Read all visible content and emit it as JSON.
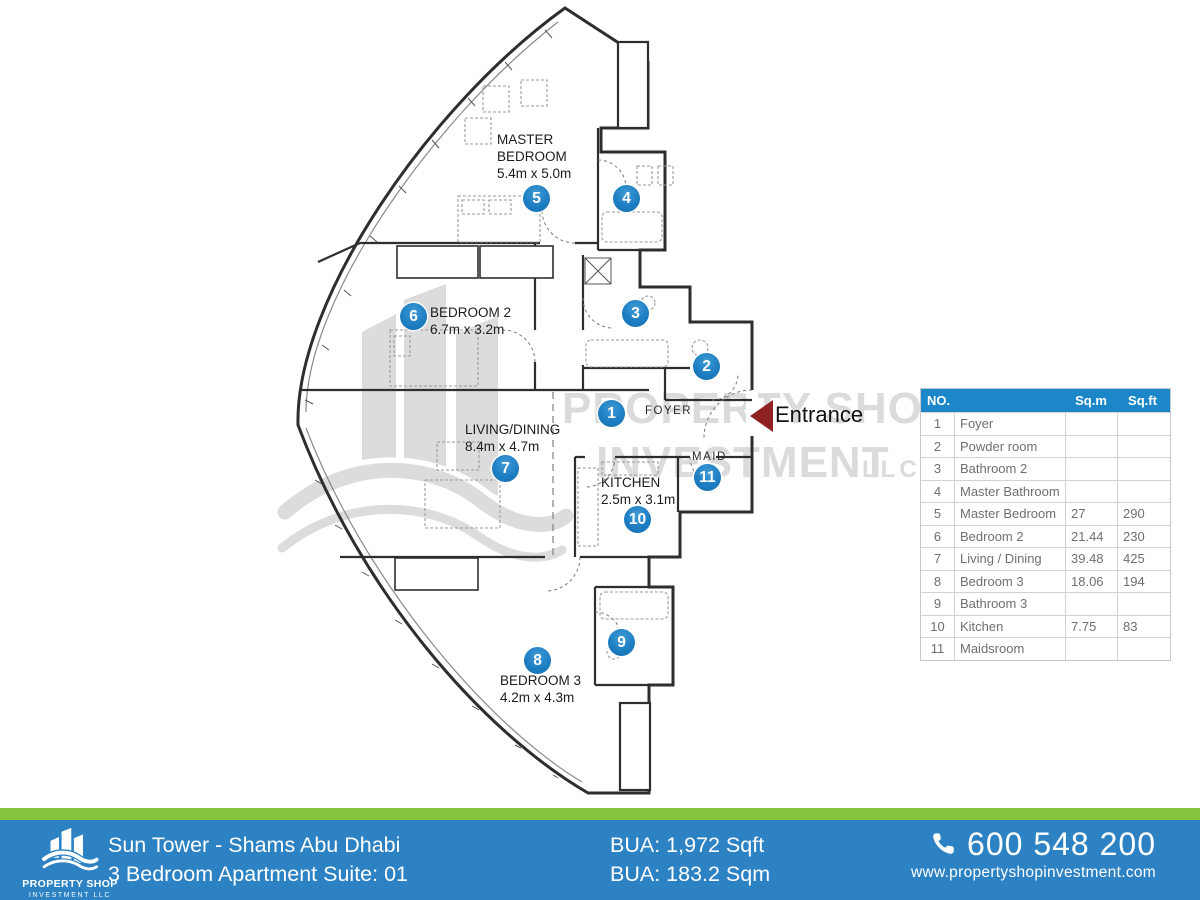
{
  "plan": {
    "entrance_label": "Entrance",
    "labels": [
      {
        "id": "master-bedroom",
        "lines": [
          "MASTER",
          "BEDROOM"
        ],
        "dims": "5.4m x 5.0m"
      },
      {
        "id": "bedroom-2",
        "lines": [
          "BEDROOM 2"
        ],
        "dims": "6.7m x 3.2m"
      },
      {
        "id": "living-dining",
        "lines": [
          "LIVING/DINING"
        ],
        "dims": "8.4m x 4.7m"
      },
      {
        "id": "kitchen",
        "lines": [
          "KITCHEN"
        ],
        "dims": "2.5m x 3.1m"
      },
      {
        "id": "bedroom-3",
        "lines": [
          "BEDROOM 3"
        ],
        "dims": "4.2m x 4.3m"
      },
      {
        "id": "foyer",
        "lines": [
          "FOYER"
        ],
        "dims": ""
      },
      {
        "id": "maid",
        "lines": [
          "MAID"
        ],
        "dims": ""
      }
    ],
    "markers": [
      "1",
      "2",
      "3",
      "4",
      "5",
      "6",
      "7",
      "8",
      "9",
      "10",
      "11"
    ]
  },
  "watermark": {
    "line1": "PROPERTY SHOP",
    "line2": "INVESTMENT",
    "suffix": "LLC"
  },
  "table": {
    "col_no": "NO.",
    "col_name": "",
    "col_sqm": "Sq.m",
    "col_sqft": "Sq.ft",
    "rows": [
      {
        "no": "1",
        "name": "Foyer",
        "sqm": "",
        "sqft": ""
      },
      {
        "no": "2",
        "name": "Powder room",
        "sqm": "",
        "sqft": ""
      },
      {
        "no": "3",
        "name": "Bathroom 2",
        "sqm": "",
        "sqft": ""
      },
      {
        "no": "4",
        "name": "Master Bathroom",
        "sqm": "",
        "sqft": ""
      },
      {
        "no": "5",
        "name": "Master Bedroom",
        "sqm": "27",
        "sqft": "290"
      },
      {
        "no": "6",
        "name": "Bedroom 2",
        "sqm": "21.44",
        "sqft": "230"
      },
      {
        "no": "7",
        "name": "Living / Dining",
        "sqm": "39.48",
        "sqft": "425"
      },
      {
        "no": "8",
        "name": "Bedroom 3",
        "sqm": "18.06",
        "sqft": "194"
      },
      {
        "no": "9",
        "name": "Bathroom 3",
        "sqm": "",
        "sqft": ""
      },
      {
        "no": "10",
        "name": "Kitchen",
        "sqm": "7.75",
        "sqft": "83"
      },
      {
        "no": "11",
        "name": "Maidsroom",
        "sqm": "",
        "sqft": ""
      }
    ]
  },
  "footer": {
    "logo_name": "PROPERTY SHOP",
    "logo_sub": "INVESTMENT LLC",
    "project": "Sun Tower - Shams Abu Dhabi",
    "unit": "3 Bedroom Apartment Suite: 01",
    "bua_sqft": "BUA: 1,972 Sqft",
    "bua_sqm": "BUA: 183.2 Sqm",
    "phone": "600 548 200",
    "website": "www.propertyshopinvestment.com"
  },
  "colors": {
    "footer_blue": "#2d82c4",
    "footer_green": "#86c440",
    "table_header_blue": "#1b87c9",
    "marker_blue": "#1d7ec2",
    "entrance_arrow_red": "#8e2222",
    "watermark_gray": "#dbdbdb",
    "wall_ink": "#2e2e2e"
  }
}
